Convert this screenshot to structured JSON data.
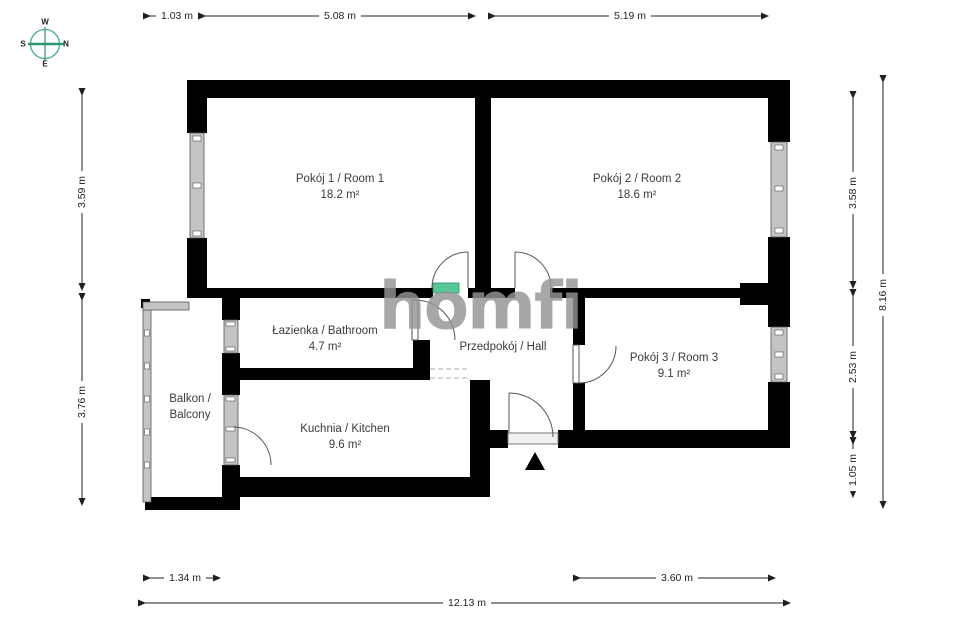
{
  "watermark": {
    "text": "homfi"
  },
  "compass": {
    "top": "W",
    "right": "N",
    "left": "S",
    "bottom": "E"
  },
  "rooms": {
    "room1": {
      "name": "Pokój 1 / Room 1",
      "area": "18.2 m²"
    },
    "room2": {
      "name": "Pokój 2 / Room 2",
      "area": "18.6 m²"
    },
    "bathroom": {
      "name": "Łazienka / Bathroom",
      "area": "4.7 m²"
    },
    "hall": {
      "name": "Przedpokój / Hall"
    },
    "room3": {
      "name": "Pokój 3 / Room 3",
      "area": "9.1 m²"
    },
    "kitchen": {
      "name": "Kuchnia / Kitchen",
      "area": "9.6 m²"
    },
    "balcony": {
      "name_line1": "Balkon /",
      "name_line2": "Balcony"
    }
  },
  "dimensions": {
    "top_left": "1.03 m",
    "top_mid": "5.08 m",
    "top_right": "5.19 m",
    "left_upper": "3.59 m",
    "left_lower": "3.76 m",
    "right_upper": "3.58 m",
    "right_mid": "2.53 m",
    "right_lower": "1.05 m",
    "right_total": "8.16 m",
    "bottom_left": "1.34 m",
    "bottom_right": "3.60 m",
    "bottom_total": "12.13 m"
  },
  "colors": {
    "wall": "#000000",
    "window": "#c4c4c4",
    "door_arc": "#555555",
    "accent_green": "#57c897",
    "watermark_gray": "#949494",
    "compass_green": "#2f9678"
  }
}
